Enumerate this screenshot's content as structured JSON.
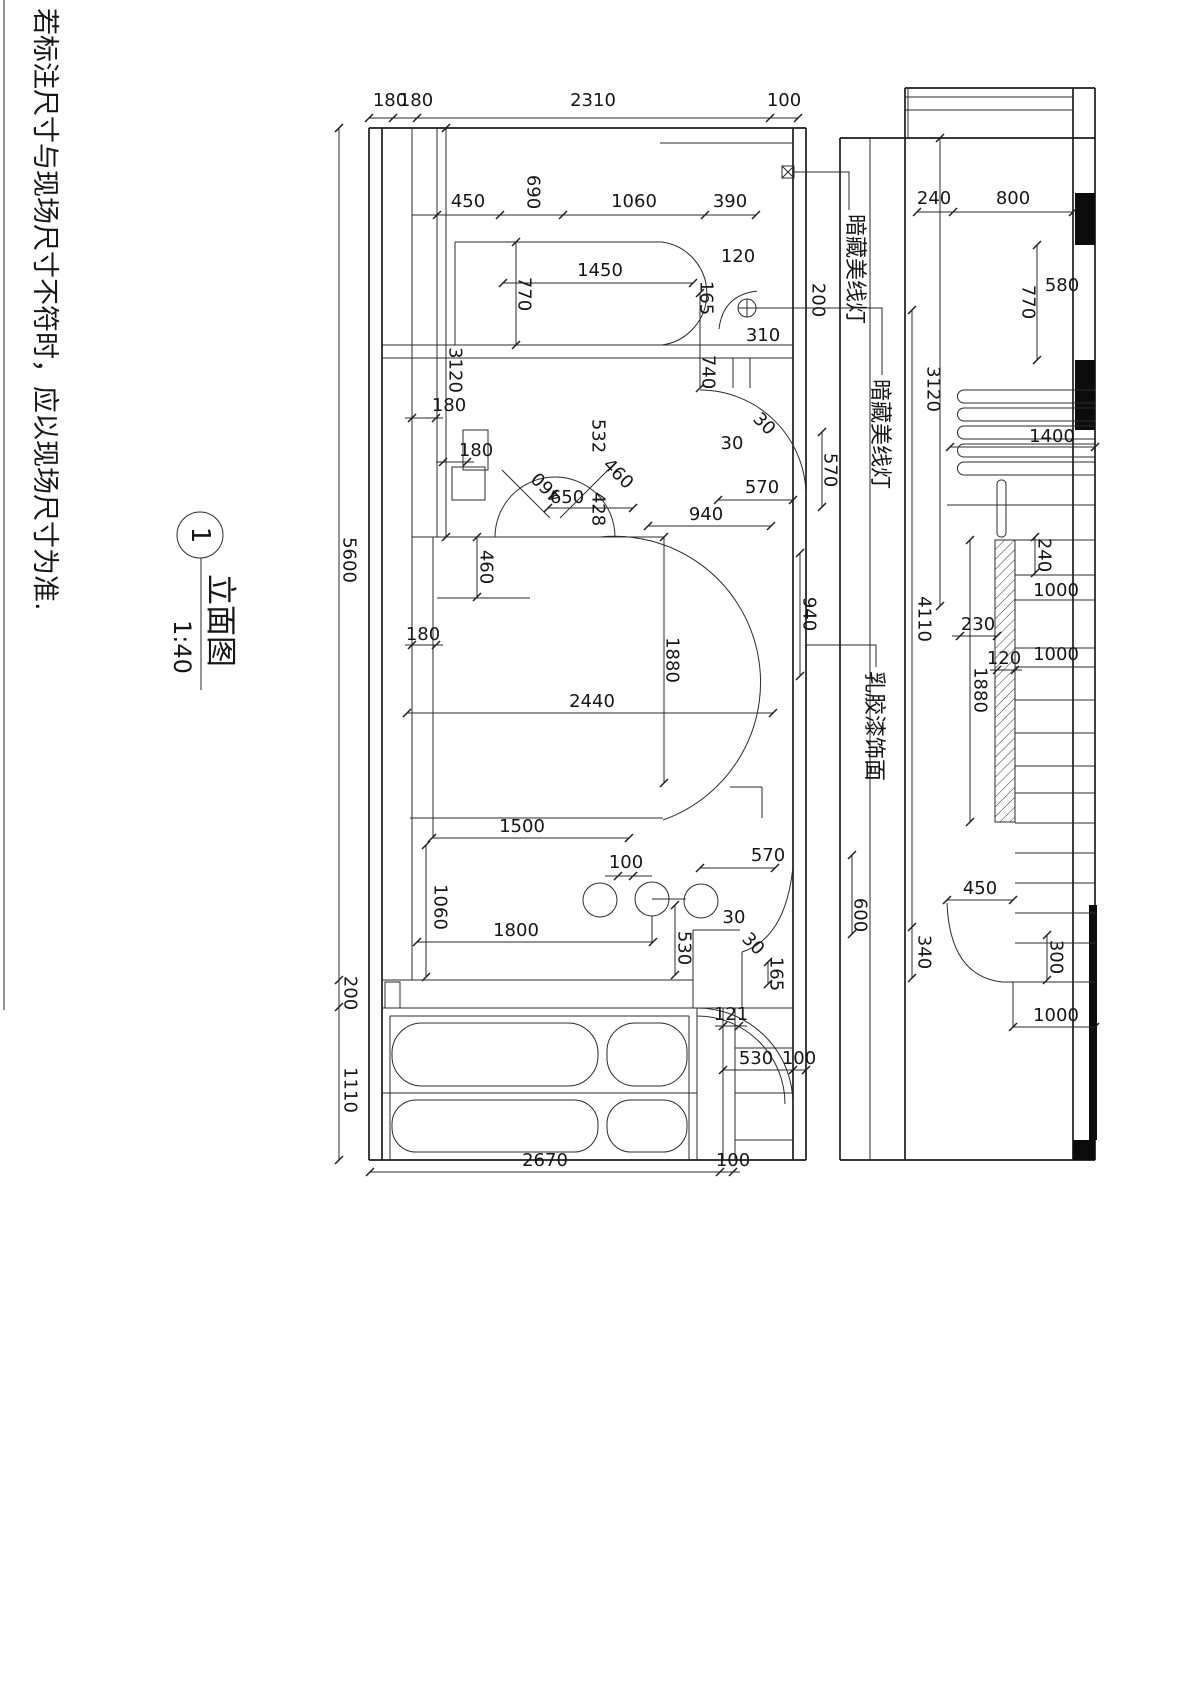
{
  "note": "若标注尺寸与现场尺寸不符时，应以现场尺寸为准.",
  "title": {
    "number": "1",
    "name": "立面图",
    "scale": "1:40"
  },
  "annotations": {
    "cove_light_1": "暗藏美线灯",
    "cove_light_2": "暗藏美线灯",
    "latex_paint": "乳胶漆饰面"
  },
  "colors": {
    "line": "#2b2b2b",
    "fill_black": "#0c0c0c",
    "paper": "#ffffff"
  },
  "dims_left": [
    "180",
    "180",
    "2310",
    "100",
    "450",
    "690",
    "1060",
    "390",
    "1450",
    "770",
    "120",
    "165",
    "200",
    "310",
    "740",
    "3120",
    "180",
    "180",
    "532",
    "460",
    "460",
    "650",
    "428",
    "30",
    "30",
    "570",
    "570",
    "940",
    "940",
    "5600",
    "460",
    "180",
    "2440",
    "1880",
    "1500",
    "100",
    "1060",
    "1800",
    "530",
    "30",
    "30",
    "570",
    "600",
    "165",
    "121",
    "200",
    "1110",
    "530",
    "100",
    "2670",
    "100"
  ],
  "dims_right": [
    "240",
    "800",
    "770",
    "580",
    "3120",
    "1400",
    "240",
    "1000",
    "1000",
    "230",
    "120",
    "1880",
    "4110",
    "450",
    "340",
    "300",
    "1000"
  ]
}
